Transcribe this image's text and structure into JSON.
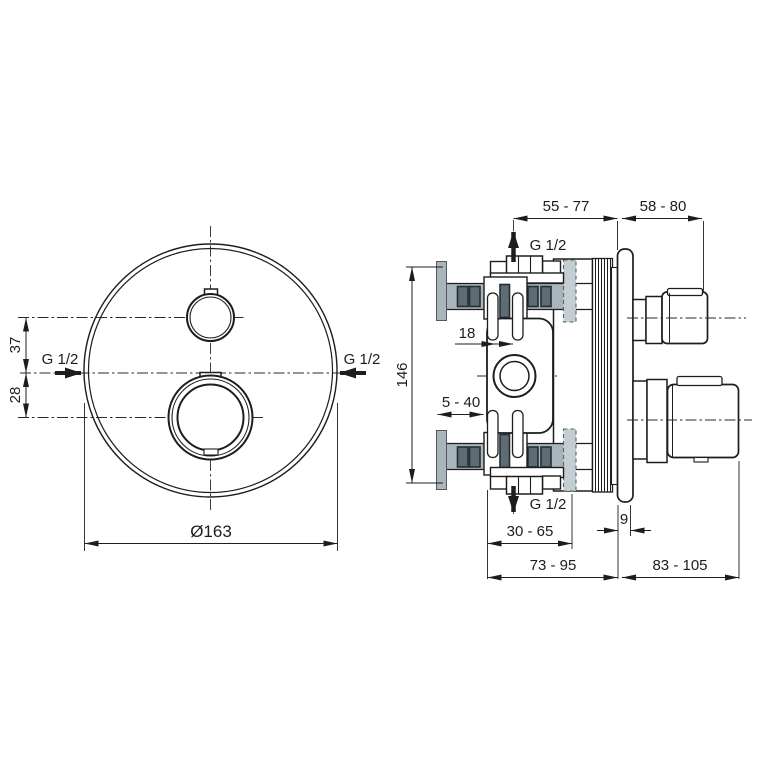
{
  "drawing": {
    "front_view": {
      "vertical_offset_top": "37",
      "vertical_offset_bottom": "28",
      "inlet_left": "G 1/2",
      "inlet_right": "G 1/2",
      "trim_diameter": "Ø163"
    },
    "side_view": {
      "rough_in_depth": "55 - 77",
      "trim_depth": "58 - 80",
      "outlet_top": "G 1/2",
      "outlet_bottom": "G 1/2",
      "body_height": "146",
      "cartridge_offset": "18",
      "plaster_range": "5 - 40",
      "buried_depth_range": "30 - 65",
      "plate_thickness": "9",
      "total_depth_wall_side": "73 - 95",
      "total_depth_front_side": "83 - 105"
    },
    "colors": {
      "line": "#1d1d1d",
      "pipe_gray": "#a9b5b9",
      "pipe_gray_light": "#c4ced2",
      "slot_dark_fill": "#5d6d73",
      "slot_dark_border": "#232f36",
      "background": "#ffffff"
    }
  }
}
